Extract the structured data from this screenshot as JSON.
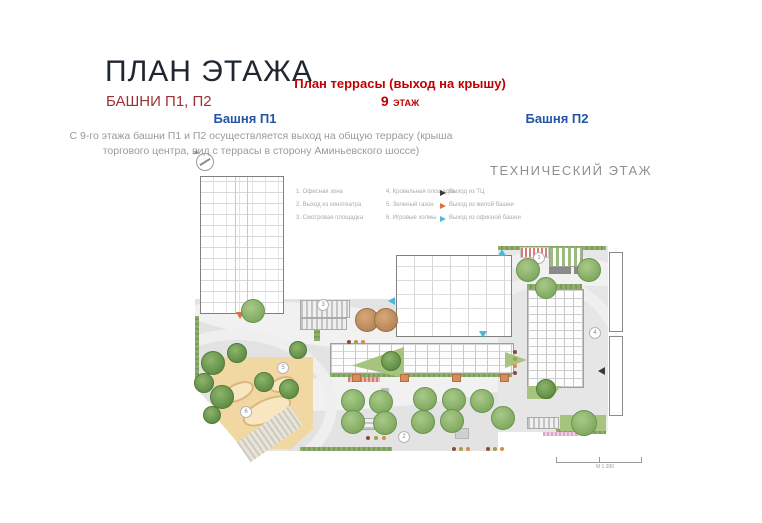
{
  "header": {
    "title": "ПЛАН ЭТАЖА",
    "subtitle": "БАШНИ П1, П2",
    "terrace_title": "План террасы (выход на крышу)",
    "floor_number": "9",
    "floor_word": "ЭТАЖ",
    "tower1_label": "Башня П1",
    "tower2_label": "Башня П2",
    "description": "С 9-го этажа башни П1 и П2 осуществляется выход на общую террасу (крыша торгового центра, вид с террасы  в сторону Аминьевского шоссе)",
    "technical_floor_label": "ТЕХНИЧЕСКИЙ ЭТАЖ"
  },
  "legend": {
    "numbered_items": [
      "1. Офисная зона",
      "2. Выход из кинотеатра",
      "3. Смотровая площадка",
      "4. Кровельная площадка",
      "5. Зеленый газон",
      "6. Игровые холмы"
    ],
    "exits": [
      {
        "label": "Выход из ТЦ",
        "color": "#3a3a3a"
      },
      {
        "label": "Выход из жилой башни",
        "color": "#e2703a"
      },
      {
        "label": "Выход из офисной башни",
        "color": "#4ab8d8"
      }
    ]
  },
  "plan": {
    "markers": [
      "1",
      "2",
      "3",
      "4",
      "5",
      "6"
    ],
    "scale_label": "М 1:200"
  },
  "colors": {
    "accent_red": "#c00000",
    "dark_red": "#9d3134",
    "tower_blue": "#2355a3",
    "gray_text": "#9a9a9a",
    "terrace_gray": "#e4e4e4",
    "tree_green": "#7fa95f",
    "sand": "#f1d7a2"
  }
}
